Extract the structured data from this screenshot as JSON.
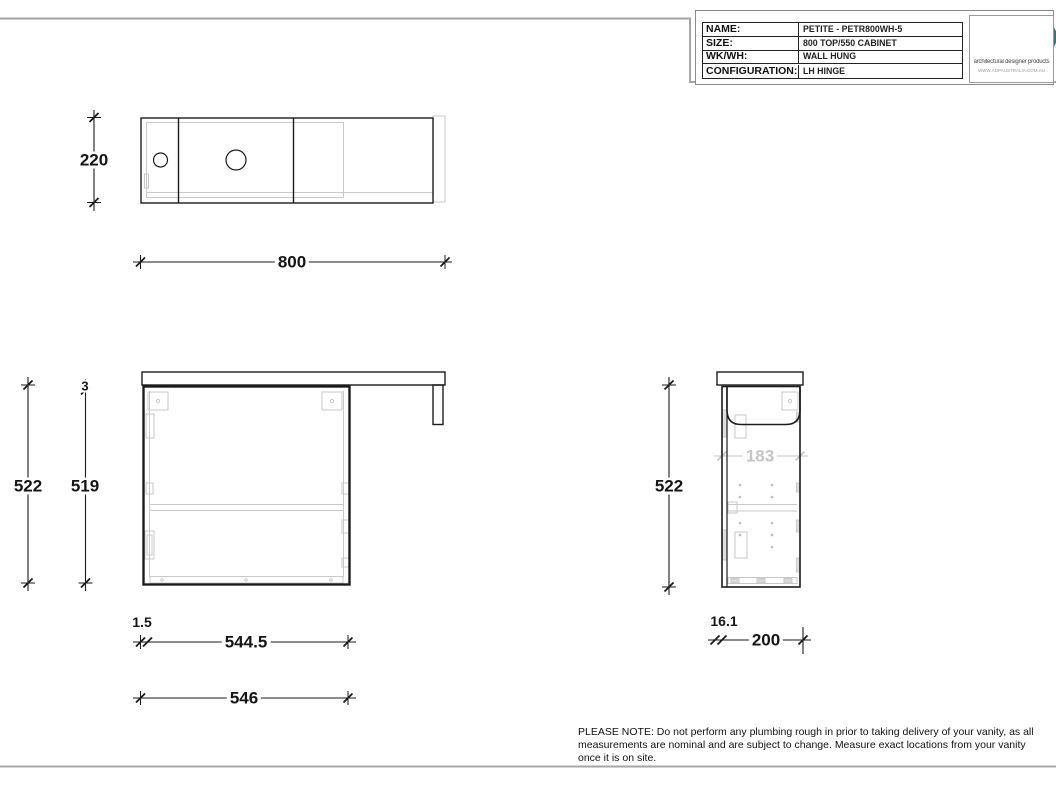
{
  "title_block": {
    "rows": [
      {
        "label": "NAME:",
        "value": "PETITE - PETR800WH-5"
      },
      {
        "label": "SIZE:",
        "value": "800 TOP/550 CABINET"
      },
      {
        "label": "WK/WH:",
        "value": "WALL HUNG"
      },
      {
        "label": "CONFIGURATION:",
        "value": "LH HINGE"
      }
    ],
    "logo": {
      "tagline": "architectural designer products",
      "website": "WWW.ADPAUSTRALIA.COM.AU",
      "teal": "#2b7a78",
      "tan": "#b5aa9d"
    }
  },
  "dimensions": {
    "top_view": {
      "depth": "220",
      "width": "800"
    },
    "front_view": {
      "overall_height": "522",
      "carcass_height": "519",
      "top_gap": "3",
      "side_offset": "1.5",
      "internal_width": "544.5",
      "carcass_width": "546"
    },
    "side_view": {
      "height": "522",
      "internal_depth": "183",
      "back_offset": "16.1",
      "depth": "200"
    }
  },
  "note": "PLEASE NOTE: Do not perform any plumbing rough in prior to taking delivery of your vanity, as all measurements are nominal and are subject to change. Measure exact locations from your vanity once it is on site."
}
